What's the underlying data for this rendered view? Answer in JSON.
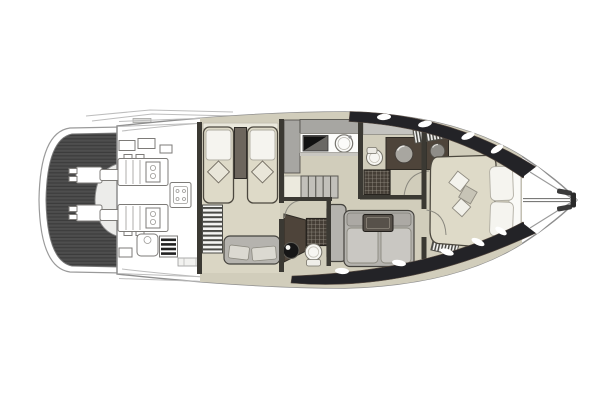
{
  "meta": {
    "type": "yacht-floor-plan",
    "view": "top-down deck / interior plan",
    "orientation": "stern-left, bow-right",
    "visible_text": "none"
  },
  "palette": {
    "background": "#ffffff",
    "outline": "#8e8e8e",
    "line_light": "#bdbdbd",
    "hull_band": "#232327",
    "teak_base": "#4e4e4e",
    "teak_stripe": "#3c3c3c",
    "deck_white": "#ffffff",
    "floor": "#d1cdbb",
    "floor_light": "#dad6c4",
    "bed": "#dedac8",
    "pillow_white": "#f5f4ef",
    "wall_dark": "#3b3933",
    "furniture_taupe": "#6d665d",
    "furniture_brown": "#4e443a",
    "cabinet_gray": "#a7a6a2",
    "cabinet_gray_light": "#c4c3bf",
    "sofa_gray": "#b5b3ae",
    "sofa_cushion": "#c9c7c2",
    "shower_dark": "#453e36",
    "grid_line": "#9a9489",
    "black_fixture": "#161616"
  },
  "regions": [
    {
      "id": "swim-platform",
      "label": "Teak swim platform with stern drives"
    },
    {
      "id": "engine-room",
      "label": "Engine room with twin engines and generator"
    },
    {
      "id": "guest-cabin",
      "label": "Guest cabin with twin beds and seat"
    },
    {
      "id": "day-head",
      "label": "Guest bathroom with shower, basin and toilet"
    },
    {
      "id": "galley",
      "label": "Galley with stove and sink"
    },
    {
      "id": "staircase",
      "label": "Companionway steps"
    },
    {
      "id": "salon",
      "label": "Salon with L-shaped sofa and tray table"
    },
    {
      "id": "master-bathroom",
      "label": "En-suite bathroom with shower, basin and toilet"
    },
    {
      "id": "master-cabin",
      "label": "Master cabin with island bed and wardrobe"
    },
    {
      "id": "bow-deck",
      "label": "Bow deck with pulpit and anchor fitting"
    }
  ]
}
